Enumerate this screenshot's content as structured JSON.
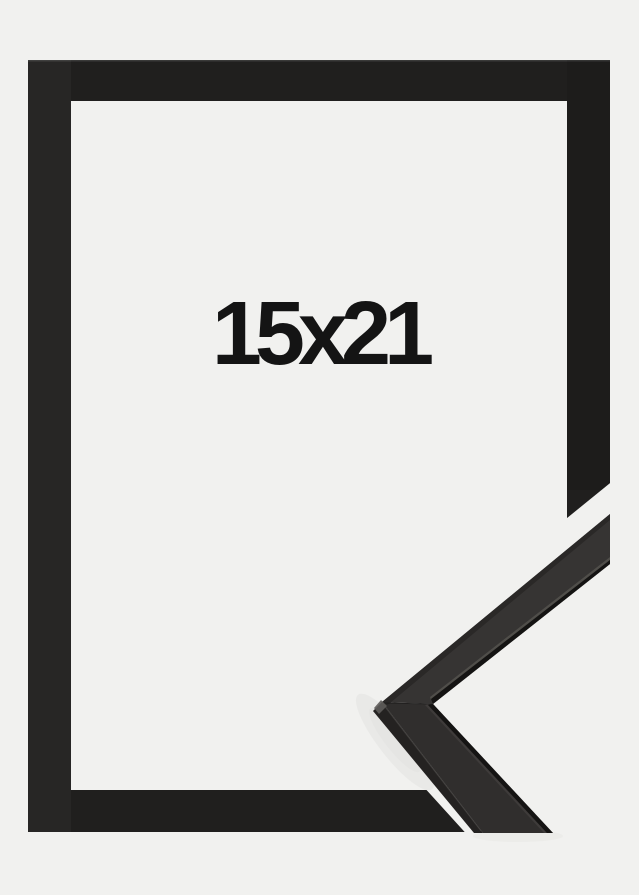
{
  "image": {
    "size_label": "15x21",
    "colors": {
      "background": "#f1f1ef",
      "frame": "#201f1e",
      "label_text": "#141414",
      "inset_face_upper": "#363433",
      "inset_face_lower": "#302e2d",
      "inset_edge_dark": "#151413",
      "inset_bevel_light": "#55534f",
      "inset_side_facet": "#242221",
      "shadow": "#e2e2e0"
    }
  }
}
